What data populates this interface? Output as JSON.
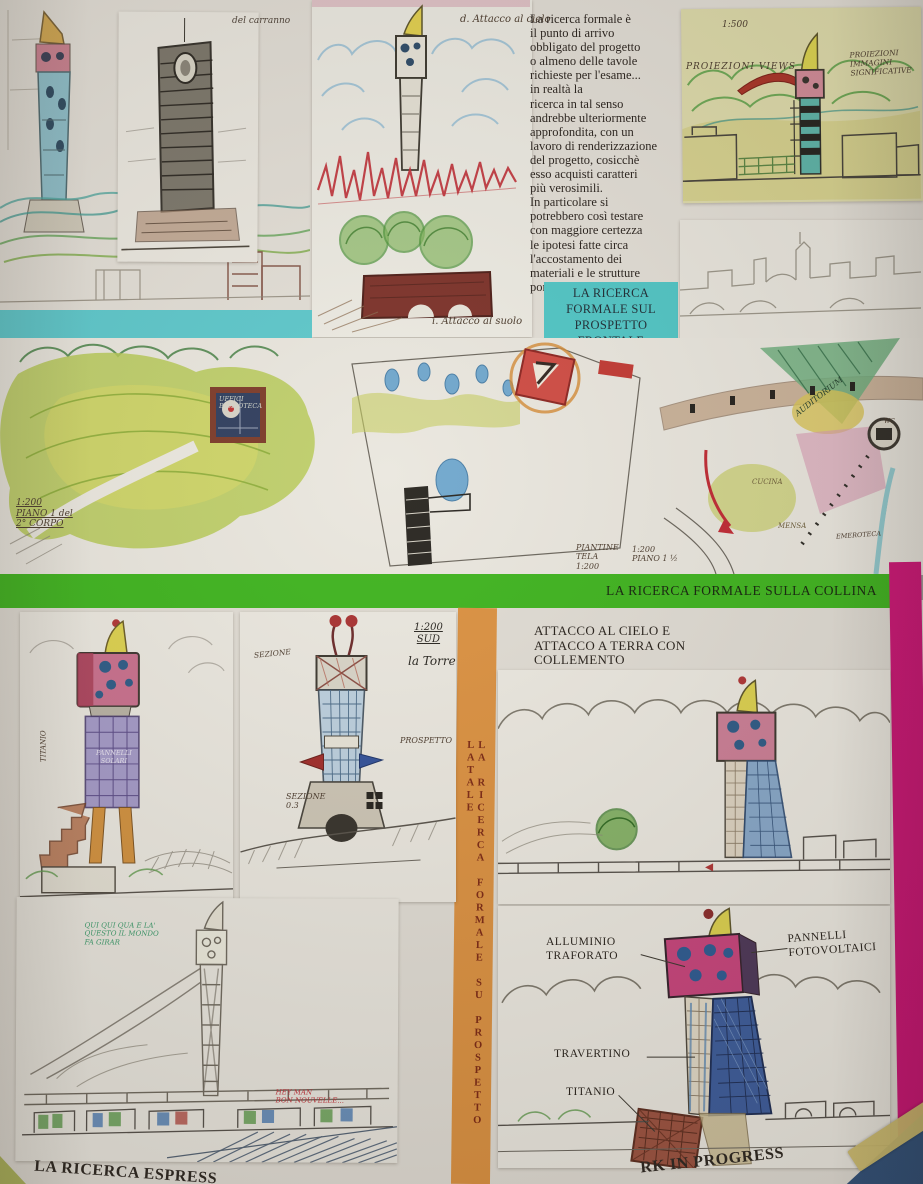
{
  "poster": {
    "top_right_wall_fragment": "…la O…",
    "intro_text": "La ricerca formale è\nil punto di arrivo\nobbligato del progetto\no almeno delle tavole\nrichieste per l'esame...\nin realtà la\nricerca in tal senso\nandrebbe ulteriormente\napprofondita, con un\nlavoro di renderizzazione\ndel progetto, cosicchè\nesso acquisti caratteri\npiù verosimili.\nIn particolare si\npotrebbero così testare\ncon maggiore certezza\nle ipotesi fatte circa\nl'accostamento dei\nmateriali e le strutture\nportanti.",
    "banner_frontale": "LA RICERCA\nFORMALE SUL\nPROSPETTO\nFRONTALE",
    "banner_collina": "LA RICERCA FORMALE SULLA COLLINA",
    "banner_laterale": "LA RICERCA FORMALE SU PROSPETTO LATALE",
    "attacco_note": "ATTACCO AL CIELO E\nATTACCO A TERRA CON\nCOLLEMENTO",
    "footer_left": "LA RICERCA ESPRESS",
    "footer_right": "RK IN PROGRESS",
    "materials": {
      "alluminio": "ALLUMINIO\nTRAFORATO",
      "pannelli": "PANNELLI\nFOTOVOLTAICI",
      "travertino": "TRAVERTINO",
      "titanio": "TITANIO"
    },
    "annotations": {
      "panel_b_title": "del carranno",
      "attacco_cielo": "d. Attacco al cielo",
      "attacco_suolo": "i. Attacco al suolo",
      "scale_1500": "1:500",
      "proiezioni_views": "PROIEZIONI VIEWS",
      "proiezioni_immagini": "PROIEZIONI\nIMMAGINI\nSIGNIFICATIVE",
      "piano_corpo": "1:200\nPIANO 1 del\n2° CORPO",
      "uffici": "UFFICI\nBIBLIOTECA",
      "piantine": "PIANTINE\nTELA\n1:200",
      "piano_15": "1:200\nPIANO 1 ½",
      "auditorium": "AUDITORIUM",
      "wc": "WC",
      "cucina": "CUCINA",
      "mensa": "MENSA",
      "emeroteca": "EMEROTECA",
      "scala_sud": "1:200\nSUD",
      "la_torre": "la Torre",
      "sezione_a": "SEZIONE",
      "prospetto": "PROSPETTO",
      "sezione_b": "SEZIONE\n0.3",
      "pannelli_solari": "PANNELLI\nSOLARI",
      "titanio_side": "TITANIO",
      "green_note": "QUI QUI QUA E LA'\nQUESTO IL MONDO\nFA GIRAR",
      "red_note": "HEY MAN\nBON NOUVELLE..."
    },
    "colors": {
      "cyan_band": "#5cc8cc",
      "green_band": "#3db41d",
      "orange_band": "#dc9140",
      "pink_band": "#ce1376",
      "yellow_paper": "#dfdcab",
      "wall_blue": "#31517a",
      "tape": "#cfbd6e"
    }
  }
}
